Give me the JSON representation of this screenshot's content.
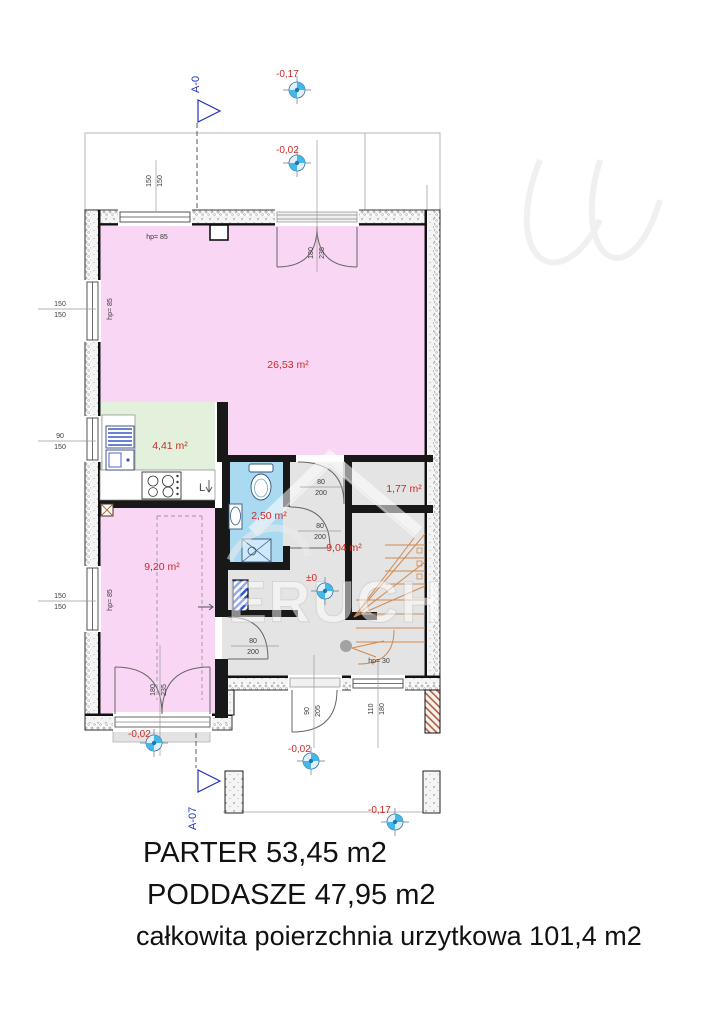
{
  "summary": {
    "line1": "PARTER 53,45 m2",
    "line2": "PODDASZE 47,95 m2",
    "line3": "całkowita poierzchnia urzytkowa 101,4 m2"
  },
  "plan": {
    "rooms": [
      {
        "id": "living",
        "label": "26,53 m²"
      },
      {
        "id": "kitchen",
        "label": "4,41 m²"
      },
      {
        "id": "bathroom",
        "label": "2,50 m²"
      },
      {
        "id": "hall",
        "label": "9,04 m²"
      },
      {
        "id": "storage",
        "label": "1,77 m²"
      },
      {
        "id": "bedroom",
        "label": "9,20 m²"
      }
    ],
    "levels": [
      {
        "label": "-0,17"
      },
      {
        "label": "-0,02"
      },
      {
        "label": "±0"
      },
      {
        "label": "-0,02"
      },
      {
        "label": "-0,02"
      },
      {
        "label": "-0,17"
      }
    ],
    "sections": [
      {
        "label": "A-0"
      },
      {
        "label": "A-07"
      }
    ],
    "openings": {
      "win_top": {
        "w": "150",
        "h": "150"
      },
      "door_top": {
        "w": "180",
        "h": "235"
      },
      "win_left_upper": {
        "w": "150",
        "h": "150"
      },
      "win_left_kitchen": {
        "w": "90",
        "h": "150"
      },
      "win_left_lower": {
        "w": "150",
        "h": "150"
      },
      "door_living": {
        "w": "80",
        "h": "200"
      },
      "door_bath": {
        "w": "80",
        "h": "200"
      },
      "door_bedroom": {
        "w": "80",
        "h": "200"
      },
      "door_terrace": {
        "w": "180",
        "h": "235"
      },
      "door_entry": {
        "w": "90",
        "h": "205"
      },
      "win_front": {
        "w": "110",
        "h": "180"
      }
    },
    "notes": {
      "hp_top": "hp= 85",
      "hp_left_upper": "hp= 85",
      "hp_left_lower": "hp= 85",
      "hp_stairs": "hp= 30",
      "fridge": "L"
    }
  },
  "watermark": {
    "text": "ERUCH"
  },
  "colors": {
    "room_pink": "#f8d6f4",
    "room_green": "#e2f0dc",
    "room_blue": "#aadaf2",
    "room_gray": "#e4e4e4",
    "label_red": "#cc2a26",
    "section_blue": "#2233bb",
    "stairs_orange": "#cf8a4e"
  }
}
